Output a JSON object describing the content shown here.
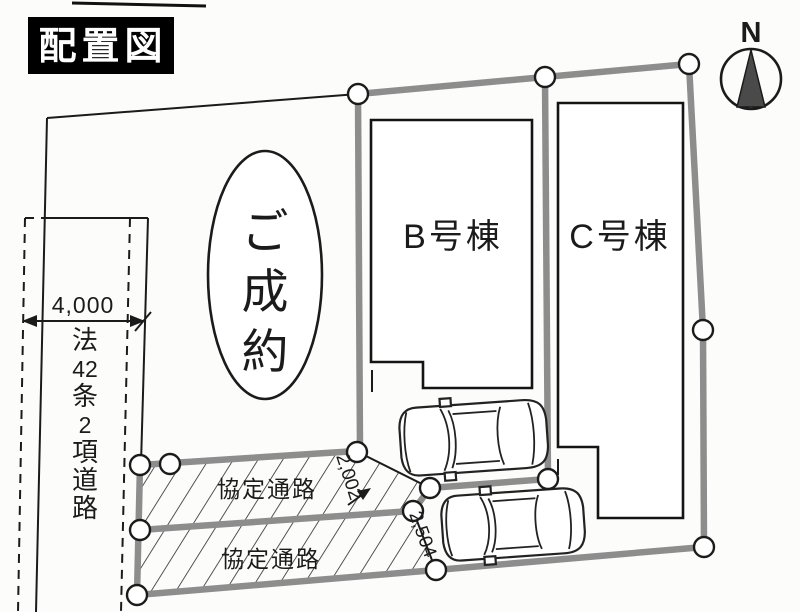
{
  "page": {
    "title": "配置図"
  },
  "compass": {
    "label": "N"
  },
  "plots": {
    "sold_label": "ご成約",
    "sold_chars": [
      "ご",
      "成",
      "約"
    ],
    "building_b_label": "B号棟",
    "building_c_label": "C号棟"
  },
  "road": {
    "name": "法42条2項道路",
    "name_chars": [
      "法",
      "42",
      "条",
      "2",
      "項",
      "道",
      "路"
    ],
    "width_label": "4,000"
  },
  "passages": {
    "upper_label": "協定通路",
    "lower_label": "協定通路",
    "dim_upper": "2,002",
    "dim_lower": "2,504"
  },
  "colors": {
    "paper": "#fcfcfa",
    "ink": "#1b1b1b",
    "boundary_gray": "#8d8d8d",
    "title_bg": "#000000",
    "title_fg": "#ffffff",
    "compass_fill": "#4a4a4a"
  }
}
